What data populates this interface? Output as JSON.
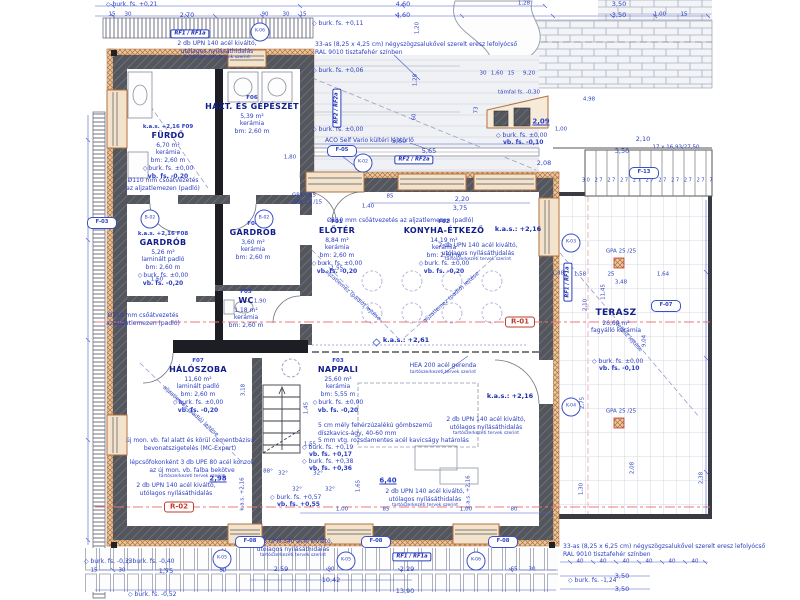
{
  "colors": {
    "dim_blue": "#2b3fc0",
    "room_blue": "#101d8a",
    "wall_gray": "#54565e",
    "wall_black": "#1d1d24",
    "insulation": "#b4703d",
    "section_red": "#c23b2e",
    "section_line": "#e87878"
  },
  "icons": {
    "level_diamond": "◇"
  },
  "rooms": [
    {
      "kas": "k.a.s. +2,16",
      "id": "F09",
      "name": "FÜRDŐ",
      "area": "6,70 m²",
      "floor": "kerámia",
      "bm": "bm: 2,60 m",
      "lvl1": "burk. fs. ±0,00",
      "lvl2": "vb. fs. -0,20"
    },
    {
      "id": "F06",
      "name": "HÁZT. ÉS GÉPÉSZET",
      "area": "5,39 m²",
      "floor": "kerámia",
      "bm": "bm: 2,60 m"
    },
    {
      "kas": "k.a.s. +2,16",
      "id": "F08",
      "name": "GARDRÓB",
      "area": "5,26 m²",
      "floor": "laminált padló",
      "bm": "bm: 2,60 m",
      "lvl1": "burk. fs. ±0,00",
      "lvl2": "vb. fs. -0,20"
    },
    {
      "id": "F04",
      "name": "GARDRÓB",
      "area": "3,60 m²",
      "floor": "kerámia",
      "bm": "bm: 2,60 m"
    },
    {
      "id": "F01",
      "name": "ELŐTÉR",
      "area": "8,84 m²",
      "floor": "kerámia",
      "bm": "bm: 2,60 m",
      "lvl1": "burk. fs. ±0,00",
      "lvl2": "vb. fs. -0,20"
    },
    {
      "id": "F02",
      "name": "KONYHA-ÉTKEZŐ",
      "area": "14,19 m²",
      "floor": "kerámia",
      "bm": "bm: 2,60 m",
      "lvl1": "burk. fs. ±0,00",
      "lvl2": "vb. fs. -0,20"
    },
    {
      "id": "F05",
      "name": "WC",
      "area": "1,18 m²",
      "floor": "kerámia",
      "bm": "bm: 2,60 m"
    },
    {
      "id": "F07",
      "name": "HÁLÓSZOBA",
      "area": "11,60 m²",
      "floor": "laminált padló",
      "bm": "bm: 2,60 m",
      "lvl1": "burk. fs. ±0,00",
      "lvl2": "vb. fs. -0,20"
    },
    {
      "id": "F03",
      "name": "NAPPALI",
      "area": "25,60 m²",
      "floor": "kerámia",
      "bm": "bm: 5,55 m",
      "lvl1": "burk. fs. ±0,00",
      "lvl2": "vb. fs. -0,20"
    },
    {
      "name": "TERASZ",
      "area": "26,60 m²",
      "floor": "fagyálló kerámia"
    }
  ],
  "ann": {
    "zsalu_top": [
      "33-as (8,25 x 4,25 cm) négyszögzsalukővel szerelt eresz lefolyócső",
      "RAL 9010 tisztafehér színben"
    ],
    "zsalu_bot": [
      "33-as (8,25 x 6,25 cm) négyszögzsalukővel szerelt eresz lefolyócső",
      "RAL 9010 tisztafehér színben"
    ],
    "aco": "ACO Self Vario kültéri lábtörlő",
    "pipe2": [
      "Ø110 mm csőátvezetés",
      "az aljzatlemezen (padló)"
    ],
    "pipe1": "Ø110 mm csőátvezetés az aljzatlemezen (padló)",
    "hea": [
      "HEA 200 acél gerenda",
      "tartószerkezeti tervek szerint"
    ],
    "upn": [
      "2 db UPN 140 acél kiváltó,",
      "utólagos nyílásáthidalás",
      "tartószerkezeti tervek szerint"
    ],
    "kavics": [
      "5 cm mély fehérzúzalékú gömbszemű",
      "díszkavics-ágy, 40-60 mm",
      "5 mm vtg. rozsdamentes acél kavicságy határolás"
    ],
    "mc": [
      "új mon. vb. fal alatt és körül cementbázisú",
      "bevonatszigetelés (MC-Expert)"
    ],
    "upe": [
      "lépcsőfokonként 3 db UPE 80 acél konzol,",
      "az új mon. vb. falba bekötve",
      "tartószerkezeti tervek szerint"
    ]
  },
  "levels": [
    {
      "x": 312,
      "y": 20,
      "l1": "burk. fs. +0,11"
    },
    {
      "x": 312,
      "y": 67,
      "l1": "burk. fs. +0,06"
    },
    {
      "x": 312,
      "y": 126,
      "l1": "burk. fs. ±0,00"
    },
    {
      "x": 106,
      "y": 1,
      "l1": "burk. fs. +0,21"
    },
    {
      "x": 496,
      "y": 132,
      "l1": "burk. fs. ±0,00",
      "l2": "vb. fs. -0,10"
    },
    {
      "x": 592,
      "y": 358,
      "l1": "burk. fs. ±0,00",
      "l2": "vb. fs. -0,10"
    },
    {
      "x": 302,
      "y": 444,
      "l1": "burk. fs. +0,19",
      "l2": "vb. fs. +0,17"
    },
    {
      "x": 302,
      "y": 458,
      "l1": "burk. fs. +0,38",
      "l2": "vb. fs. +0,36"
    },
    {
      "x": 270,
      "y": 494,
      "l1": "burk. fs. +0,57",
      "l2": "vb. fs. +0,55"
    },
    {
      "x": 84,
      "y": 558,
      "l1": "burk. fs. -0,33"
    },
    {
      "x": 126,
      "y": 558,
      "l1": "burk. fs. -0,40"
    },
    {
      "x": 128,
      "y": 591,
      "l1": "burk. fs. -0,52"
    },
    {
      "x": 568,
      "y": 577,
      "l1": "burk. fs. -1,24"
    }
  ],
  "kas": [
    {
      "x": 518,
      "y": 229,
      "t": "k.a.s.: +2,16"
    },
    {
      "x": 510,
      "y": 396,
      "t": "k.a.s.: +2,16"
    },
    {
      "x": 406,
      "y": 340,
      "t": "k.a.s.: +2,61"
    }
  ],
  "markers": {
    "circles": [
      {
        "t": "K-06",
        "x": 260,
        "y": 32
      },
      {
        "t": "K-02",
        "x": 363,
        "y": 163
      },
      {
        "t": "K-03",
        "x": 571,
        "y": 243
      },
      {
        "t": "K-04",
        "x": 571,
        "y": 407
      },
      {
        "t": "K-05",
        "x": 222,
        "y": 559
      },
      {
        "t": "K-05",
        "x": 346,
        "y": 561
      },
      {
        "t": "K-06",
        "x": 476,
        "y": 561
      },
      {
        "t": "B-02",
        "x": 150,
        "y": 219
      },
      {
        "t": "B-02",
        "x": 264,
        "y": 219
      }
    ],
    "ovals": [
      {
        "t": "F-05",
        "x": 342,
        "y": 151
      },
      {
        "t": "F-13",
        "x": 644,
        "y": 173
      },
      {
        "t": "F-07",
        "x": 666,
        "y": 306
      },
      {
        "t": "F-03",
        "x": 102,
        "y": 223
      },
      {
        "t": "F-08",
        "x": 250,
        "y": 542
      },
      {
        "t": "F-08",
        "x": 376,
        "y": 542
      },
      {
        "t": "F-08",
        "x": 503,
        "y": 542
      }
    ],
    "rf": [
      {
        "t": "RF1 / RF1a",
        "x": 190,
        "y": 34
      },
      {
        "t": "RF2 / RF2a",
        "x": 414,
        "y": 160
      },
      {
        "t": "RF2 / RF2a",
        "x": 337,
        "y": 108,
        "r": -90
      },
      {
        "t": "RF1 / RF1a",
        "x": 412,
        "y": 557
      },
      {
        "t": "RF1 / RF1a",
        "x": 568,
        "y": 282,
        "r": -90
      }
    ],
    "sections": [
      {
        "t": "R-01",
        "x": 520,
        "y": 322
      },
      {
        "t": "R-02",
        "x": 179,
        "y": 507
      }
    ]
  },
  "dim_labels": [
    {
      "t": "4,60",
      "x": 403,
      "y": 4
    },
    {
      "t": "4,60",
      "x": 403,
      "y": 15
    },
    {
      "t": "1,28",
      "x": 524,
      "y": 4,
      "c": "s"
    },
    {
      "t": "3,50",
      "x": 619,
      "y": 4
    },
    {
      "t": "3,50",
      "x": 619,
      "y": 15
    },
    {
      "t": "1,00",
      "x": 660,
      "y": 15,
      "c": "s"
    },
    {
      "t": "15",
      "x": 684,
      "y": 15,
      "c": "s"
    },
    {
      "t": "2,70",
      "x": 187,
      "y": 15
    },
    {
      "t": "15",
      "x": 112,
      "y": 15,
      "c": "s"
    },
    {
      "t": "30",
      "x": 128,
      "y": 15,
      "c": "s"
    },
    {
      "t": "90",
      "x": 265,
      "y": 15,
      "c": "s"
    },
    {
      "t": "30",
      "x": 286,
      "y": 15,
      "c": "s"
    },
    {
      "t": "15",
      "x": 303,
      "y": 15,
      "c": "s"
    },
    {
      "t": "1,20",
      "x": 418,
      "y": 28,
      "r": -90,
      "c": "s"
    },
    {
      "t": "1,28",
      "x": 416,
      "y": 80,
      "r": -90,
      "c": "s"
    },
    {
      "t": "60",
      "x": 415,
      "y": 117,
      "r": -90,
      "c": "s"
    },
    {
      "t": "5,60",
      "x": 399,
      "y": 141
    },
    {
      "t": "5,65",
      "x": 429,
      "y": 151
    },
    {
      "t": "2,08",
      "x": 544,
      "y": 163
    },
    {
      "t": "85",
      "x": 390,
      "y": 197,
      "c": "s"
    },
    {
      "t": "1,40",
      "x": 368,
      "y": 207,
      "c": "s"
    },
    {
      "t": "2,20",
      "x": 462,
      "y": 199
    },
    {
      "t": "3,75",
      "x": 460,
      "y": 208
    },
    {
      "t": "30",
      "x": 483,
      "y": 74,
      "c": "s"
    },
    {
      "t": "1,60",
      "x": 497,
      "y": 74,
      "c": "s"
    },
    {
      "t": "15",
      "x": 511,
      "y": 74,
      "c": "s"
    },
    {
      "t": "9,20",
      "x": 529,
      "y": 74,
      "c": "s"
    },
    {
      "t": "4,98",
      "x": 589,
      "y": 100,
      "c": "s"
    },
    {
      "t": "1,00",
      "x": 561,
      "y": 130,
      "c": "s"
    },
    {
      "t": "2,10",
      "x": 643,
      "y": 139
    },
    {
      "t": "3,50",
      "x": 622,
      "y": 151
    },
    {
      "t": "17 x 16,93/27,50",
      "x": 676,
      "y": 148,
      "c": "s"
    },
    {
      "t": "30 27 27 27 27 27 27 27 27 27 7",
      "x": 648,
      "y": 181,
      "c": "t"
    },
    {
      "t": "támfal fs. -0,30",
      "x": 519,
      "y": 93,
      "c": "s"
    },
    {
      "t": "2,09",
      "x": 541,
      "y": 122,
      "c": "b"
    },
    {
      "t": "73",
      "x": 477,
      "y": 110,
      "r": -90,
      "c": "s"
    },
    {
      "t": "1,38",
      "x": 558,
      "y": 274,
      "c": "s"
    },
    {
      "t": "1,58",
      "x": 580,
      "y": 275,
      "c": "s"
    },
    {
      "t": "25",
      "x": 611,
      "y": 275,
      "c": "s"
    },
    {
      "t": "1,64",
      "x": 663,
      "y": 275,
      "c": "s"
    },
    {
      "t": "3,48",
      "x": 621,
      "y": 283,
      "c": "s"
    },
    {
      "t": "11,45",
      "x": 604,
      "y": 292,
      "r": -90,
      "c": "s"
    },
    {
      "t": "2,10",
      "x": 586,
      "y": 305,
      "r": -90,
      "c": "s"
    },
    {
      "t": "9,04",
      "x": 645,
      "y": 341,
      "r": -90,
      "c": "s"
    },
    {
      "t": "2,75",
      "x": 583,
      "y": 403,
      "r": -90,
      "c": "s"
    },
    {
      "t": "1,30",
      "x": 582,
      "y": 489,
      "r": -90,
      "c": "s"
    },
    {
      "t": "2,08",
      "x": 633,
      "y": 468,
      "r": -90,
      "c": "s"
    },
    {
      "t": "2,38",
      "x": 702,
      "y": 478,
      "r": -90,
      "c": "s"
    },
    {
      "t": "GPA Ø15",
      "x": 304,
      "y": 196,
      "c": "s"
    },
    {
      "t": "GPA 15 /15",
      "x": 307,
      "y": 203,
      "c": "s"
    },
    {
      "t": "GPA 25 /25",
      "x": 621,
      "y": 252,
      "c": "s"
    },
    {
      "t": "GPA 25 /25",
      "x": 621,
      "y": 412,
      "c": "s"
    },
    {
      "t": "1,80",
      "x": 290,
      "y": 158,
      "c": "s"
    },
    {
      "t": "1,60",
      "x": 157,
      "y": 280,
      "c": "s"
    },
    {
      "t": "1,90",
      "x": 260,
      "y": 302,
      "c": "s"
    },
    {
      "t": "2,98",
      "x": 218,
      "y": 479,
      "c": "b"
    },
    {
      "t": "6,40",
      "x": 388,
      "y": 481,
      "c": "b"
    },
    {
      "t": "1,55",
      "x": 310,
      "y": 445,
      "c": "s"
    },
    {
      "t": "1,55",
      "x": 337,
      "y": 269,
      "c": "s"
    },
    {
      "t": "1,45",
      "x": 307,
      "y": 408,
      "r": -90,
      "c": "s"
    },
    {
      "t": "1,65",
      "x": 359,
      "y": 486,
      "r": -90,
      "c": "s"
    },
    {
      "t": "3,18",
      "x": 244,
      "y": 390,
      "r": -90,
      "c": "s"
    },
    {
      "t": "88°",
      "x": 268,
      "y": 472,
      "c": "s"
    },
    {
      "t": "32°",
      "x": 283,
      "y": 474,
      "c": "s"
    },
    {
      "t": "32°",
      "x": 318,
      "y": 474,
      "c": "s"
    },
    {
      "t": "32°",
      "x": 297,
      "y": 490,
      "c": "s"
    },
    {
      "t": "32°",
      "x": 330,
      "y": 490,
      "c": "s"
    },
    {
      "t": "k.a.s. +2,16",
      "x": 243,
      "y": 494,
      "r": -90,
      "c": "s"
    },
    {
      "t": "k.a.s. +2,16",
      "x": 469,
      "y": 492,
      "r": -90,
      "c": "s"
    },
    {
      "t": "1,00",
      "x": 342,
      "y": 510,
      "c": "s"
    },
    {
      "t": "85",
      "x": 386,
      "y": 510,
      "c": "s"
    },
    {
      "t": "1,00",
      "x": 466,
      "y": 510,
      "c": "s"
    },
    {
      "t": "80",
      "x": 514,
      "y": 510,
      "c": "s"
    },
    {
      "t": "15",
      "x": 94,
      "y": 571,
      "c": "s"
    },
    {
      "t": "30",
      "x": 122,
      "y": 571,
      "c": "s"
    },
    {
      "t": "1,75",
      "x": 166,
      "y": 571
    },
    {
      "t": "50",
      "x": 223,
      "y": 571,
      "c": "s"
    },
    {
      "t": "2,59",
      "x": 281,
      "y": 569
    },
    {
      "t": "90",
      "x": 331,
      "y": 570,
      "c": "s"
    },
    {
      "t": "2,29",
      "x": 407,
      "y": 569
    },
    {
      "t": "65",
      "x": 514,
      "y": 570,
      "c": "s"
    },
    {
      "t": "30",
      "x": 532,
      "y": 570,
      "c": "s"
    },
    {
      "t": "10,42",
      "x": 331,
      "y": 580
    },
    {
      "t": "13,90",
      "x": 405,
      "y": 591
    },
    {
      "t": "40",
      "x": 580,
      "y": 562,
      "c": "s"
    },
    {
      "t": "40",
      "x": 603,
      "y": 562,
      "c": "s"
    },
    {
      "t": "40",
      "x": 626,
      "y": 562,
      "c": "s"
    },
    {
      "t": "40",
      "x": 649,
      "y": 562,
      "c": "s"
    },
    {
      "t": "40",
      "x": 672,
      "y": 562,
      "c": "s"
    },
    {
      "t": "40",
      "x": 695,
      "y": 562,
      "c": "s"
    },
    {
      "t": "3,50",
      "x": 622,
      "y": 576
    },
    {
      "t": "3,50",
      "x": 622,
      "y": 589
    },
    {
      "t": "aljzatlemez (padló) lejtése",
      "x": 352,
      "y": 296,
      "r": 42,
      "c": "s"
    },
    {
      "t": "aljzatlemez (padló) lejtése",
      "x": 452,
      "y": 298,
      "r": -42,
      "c": "s"
    },
    {
      "t": "aljzatlemez (padló) lejtése",
      "x": 190,
      "y": 412,
      "r": 42,
      "c": "s"
    },
    {
      "t": "terasz lejtése",
      "x": 628,
      "y": 338,
      "r": 48,
      "c": "s"
    }
  ]
}
